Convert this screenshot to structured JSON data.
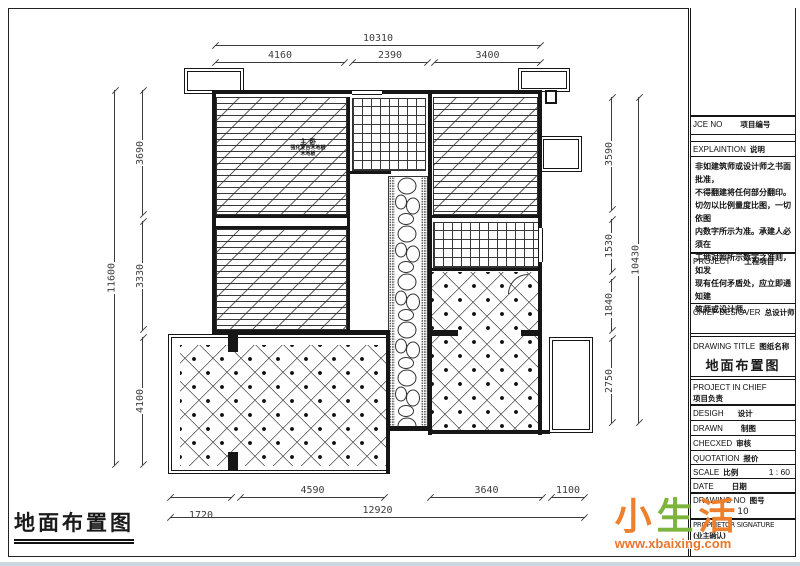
{
  "stamp": {
    "title": "地面布置图"
  },
  "plan": {
    "room_label": {
      "line1": "主 卧",
      "line2": "强化复合木地板",
      "line3": "木地板"
    },
    "dims": {
      "top": {
        "overall": "10310",
        "segments": [
          "4160",
          "2390",
          "3400"
        ]
      },
      "left": {
        "overall": "11600",
        "segments": [
          "3690",
          "3330",
          "4100"
        ]
      },
      "right": {
        "overall": "10430",
        "segments": [
          "3590",
          "1530",
          "1840",
          "2750"
        ]
      },
      "bottom": {
        "overall": "12920",
        "segments": [
          "1720",
          "4590",
          "3640",
          "1100"
        ]
      }
    }
  },
  "title_block": {
    "project_no": {
      "en": "JCE NO",
      "zh": "项目编号"
    },
    "explanation": {
      "en": "EXPLAINTION",
      "zh": "说明",
      "body": "非如建筑师或设计师之书面批准，\n不得翻建将任何部分翻印。\n切勿以比例量度比图，一切依图\n内数字所示为准。承建人必须在\n工地对照所示数字之准则，如发\n现有任何矛盾处，应立即通知建\n筑师或设计师。"
    },
    "project": {
      "en": "PROJECT",
      "zh": "工程项目"
    },
    "chief_designer": {
      "en": "CHIEF DESIGVER",
      "zh": "总设计师"
    },
    "drawing_title": {
      "en": "DRAWING TITLE",
      "zh": "图纸名称",
      "value": "地面布置图"
    },
    "project_in_chief": {
      "en": "PROJECT IN CHIEF",
      "zh": "项目负责"
    },
    "design": {
      "en": "DESIGH",
      "zh": "设计"
    },
    "drawn": {
      "en": "DRAWN",
      "zh": "制图"
    },
    "checked": {
      "en": "CHECXED",
      "zh": "审核"
    },
    "quotation": {
      "en": "QUOTATION",
      "zh": "报价"
    },
    "scale": {
      "en": "SCALE",
      "zh": "比例",
      "value": "1 : 60"
    },
    "date": {
      "en": "DATE",
      "zh": "日期"
    },
    "drawing_no": {
      "en": "DRAWING NO",
      "zh": "图号",
      "value": "10"
    },
    "proprietor": {
      "en": "PROPRIETOR SIGNATURE",
      "zh": "(业主确认)"
    }
  },
  "watermark": {
    "char1": "小",
    "char2": "生",
    "char3": "活",
    "url": "www.xbaixing.com"
  },
  "colors": {
    "line": "#1a1a1a",
    "watermark_orange": "#ee7f2d",
    "watermark_green": "#7db43c"
  }
}
